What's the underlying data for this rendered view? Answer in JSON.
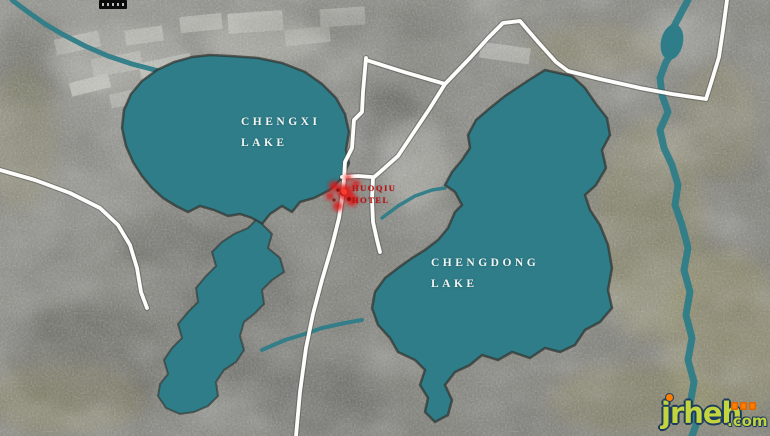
{
  "map": {
    "lake_west": {
      "line1": "CHENGXI",
      "line2": "LAKE"
    },
    "lake_east": {
      "line1": "CHENGDONG",
      "line2": "LAKE"
    },
    "marker": {
      "line1": "HUOQIU",
      "line2": "HOTEL"
    },
    "colors": {
      "water": "#2e7d88",
      "road": "#fdfdfb",
      "marker_red": "#e01212",
      "marker_text": "#bb1111",
      "lake_label": "#f2f5f3"
    }
  },
  "watermark": {
    "site": "jrheh",
    "tld": ".com",
    "text_color": "#c2d43e",
    "accent": "#ff7d00"
  }
}
